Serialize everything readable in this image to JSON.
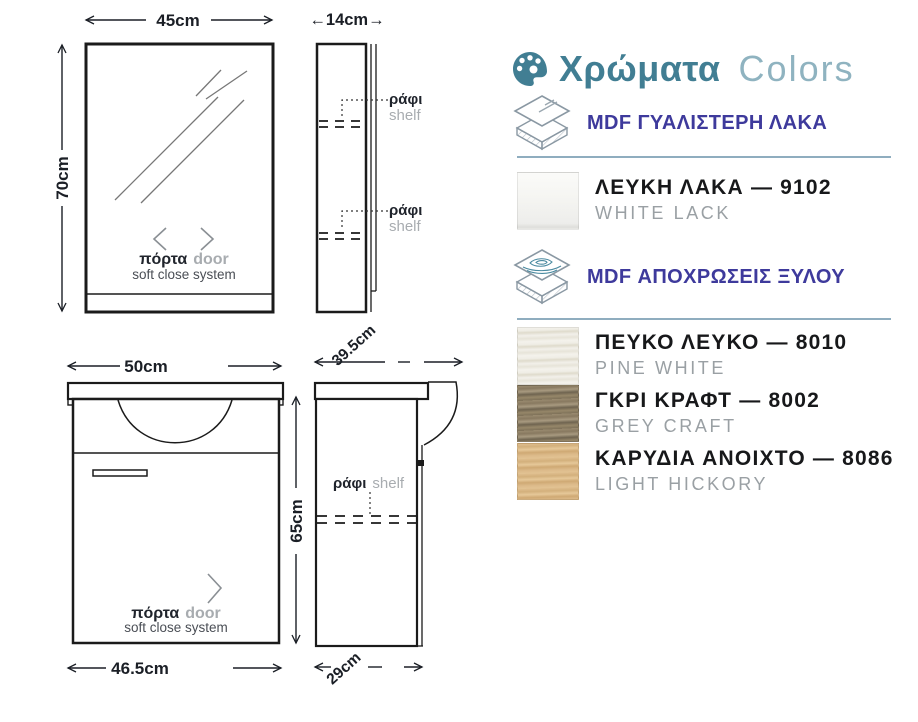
{
  "theme": {
    "accent_teal": "#417E93",
    "accent_teal_light": "#8FB3C0",
    "accent_purple": "#3E3A9C",
    "separator_line": "#8FADBF",
    "drawing_ink": "#1B1F26",
    "muted_grey": "#9AA0A4"
  },
  "drawings": {
    "labels": {
      "door_greek": "πόρτα",
      "door_english": "door",
      "soft_close": "soft close system",
      "shelf_greek": "ράφι",
      "shelf_english": "shelf"
    },
    "dimensions": {
      "mirror_width": "45cm",
      "mirror_height": "70cm",
      "mirror_depth": "←14cm→",
      "vanity_width_top": "50cm",
      "vanity_width_bottom": "46.5cm",
      "vanity_height": "65cm",
      "vanity_depth_top": "39.5cm",
      "vanity_depth_bottom": "29cm"
    }
  },
  "colors_panel": {
    "title_greek": "Χρώματα",
    "title_latin": "Colors",
    "sections": [
      {
        "material_label": "MDF ΓΥΑΛΙΣΤΕΡΗ ΛΑΚΑ",
        "icon": "mdf-gloss-lacquer-icon",
        "finishes": [
          {
            "title": "ΛΕΥΚΗ ΛΑΚΑ — 9102",
            "subtitle": "WHITE LACK",
            "swatch": "white-lack",
            "swatch_color": "#F2F2EF"
          }
        ]
      },
      {
        "material_label": "MDF ΑΠΟΧΡΩΣΕΙΣ ΞΥΛΟΥ",
        "icon": "mdf-wood-shades-icon",
        "finishes": [
          {
            "title": "ΠΕΥΚΟ ΛΕΥΚΟ — 8010",
            "subtitle": "PINE WHITE",
            "swatch": "pine-white",
            "swatch_color": "#F0EEE6"
          },
          {
            "title": "ΓΚΡΙ ΚΡΑΦΤ — 8002",
            "subtitle": "GREY CRAFT",
            "swatch": "grey-craft",
            "swatch_color": "#95866B"
          },
          {
            "title": "ΚΑΡΥΔΙΑ ΑΝΟΙΧΤΟ — 8086",
            "subtitle": "LIGHT HICKORY",
            "swatch": "light-hickory",
            "swatch_color": "#DCBA8A"
          }
        ]
      }
    ]
  }
}
